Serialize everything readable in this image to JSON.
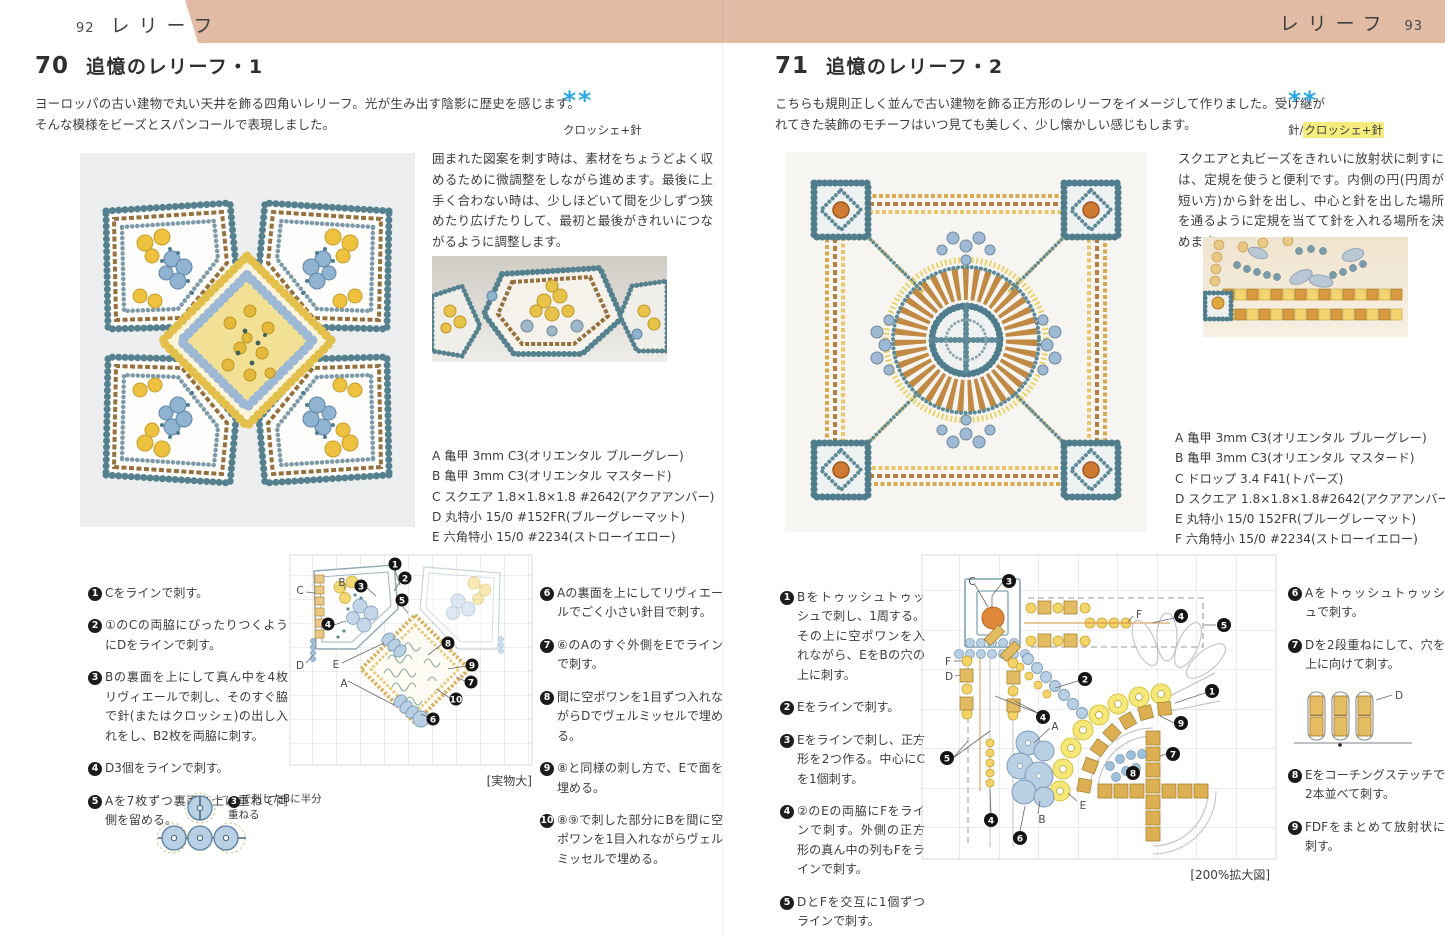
{
  "banner": {
    "color": "#e2bba4"
  },
  "left": {
    "page_number": "92",
    "section_label": "レリーフ",
    "item_number": "70",
    "title": "追憶のレリーフ・1",
    "description": "ヨーロッパの古い建物で丸い天井を飾る四角いレリーフ。光が生み出す陰影に歴史を感じます。そんな模様をビーズとスパンコールで表現しました。",
    "stars": "**",
    "technique": "クロッシェ+針",
    "tip": "囲まれた図案を刺す時は、素材をちょうどよく収めるために微調整をしながら進めます。最後に上手く合わない時は、少しほどいて間を少しずつ狭めたり広げたりして、最初と最後がきれいにつながるように調整します。",
    "materials": [
      "A 亀甲 3mm C3(オリエンタル ブルーグレー)",
      "B 亀甲 3mm C3(オリエンタル マスタード)",
      "C スクエア 1.8×1.8×1.8 #2642(アクアアンバー)",
      "D 丸特小 15/0 #152FR(ブルーグレーマット)",
      "E 六角特小 15/0 #2234(ストローイエロー)"
    ],
    "steps_col1": [
      {
        "num": "1",
        "text": "Cをラインで刺す。"
      },
      {
        "num": "2",
        "text": "①のCの両脇にぴったりつくようにDをラインで刺す。"
      },
      {
        "num": "3",
        "text": "Bの裏面を上にして真ん中を4枚リヴィエールで刺し、そのすぐ脇で針(またはクロッシェ)の出し入れをし、B2枚を両脇に刺す。"
      },
      {
        "num": "4",
        "text": "D3個をラインで刺す。"
      },
      {
        "num": "5",
        "text": "Aを7枚ずつ裏面を上に重ねて両側を留める。"
      }
    ],
    "steps_col2": [
      {
        "num": "6",
        "text": "Aの裏面を上にしてリヴィエールでごく小さい針目で刺す。"
      },
      {
        "num": "7",
        "text": "⑥のAのすぐ外側をEでラインで刺す。"
      },
      {
        "num": "8",
        "text": "間に空ポワンを1目ずつ入れながらDでヴェルミッセルで埋める。"
      },
      {
        "num": "9",
        "text": "⑧と同様の刺し方で、Eで面を埋める。"
      },
      {
        "num": "10",
        "text": "⑧⑨で刺した部分にBを間に空ポワンを1目入れながらヴェルミッセルで埋める。"
      }
    ],
    "note": {
      "num": "3",
      "text": "で刺したBに半分重ねる"
    },
    "diagram": {
      "scale_label": "[実物大]",
      "letters": [
        "C",
        "B",
        "D",
        "E",
        "A"
      ],
      "numbers": [
        "1",
        "2",
        "3",
        "4",
        "5",
        "6",
        "7",
        "8",
        "9",
        "10"
      ]
    }
  },
  "right": {
    "page_number": "93",
    "section_label": "レリーフ",
    "item_number": "71",
    "title": "追憶のレリーフ・2",
    "description": "こちらも規則正しく並んで古い建物を飾る正方形のレリーフをイメージして作りました。受け継がれてきた装飾のモチーフはいつ見ても美しく、少し懐かしい感じもします。",
    "stars": "**",
    "technique_prefix": "針/",
    "technique_highlight": "クロッシェ+針",
    "tip": "スクエアと丸ビーズをきれいに放射状に刺すには、定規を使うと便利です。内側の円(円周が短い方)から針を出し、中心と針を出した場所を通るように定規を当てて針を入れる場所を決めます。",
    "materials": [
      "A 亀甲 3mm C3(オリエンタル ブルーグレー)",
      "B 亀甲 3mm C3(オリエンタル マスタード)",
      "C ドロップ 3.4 F41(トパーズ)",
      "D スクエア 1.8×1.8×1.8#2642(アクアアンバー)",
      "E 丸特小 15/0 152FR(ブルーグレーマット)",
      "F 六角特小 15/0 #2234(ストローイエロー)"
    ],
    "steps_col1": [
      {
        "num": "1",
        "text": "Bをトゥッシュトゥッシュで刺し、1周する。その上に空ポワンを入れながら、EをBの穴の上に刺す。"
      },
      {
        "num": "2",
        "text": "Eをラインで刺す。"
      },
      {
        "num": "3",
        "text": "Eをラインで刺し、正方形を2つ作る。中心にCを1個刺す。"
      },
      {
        "num": "4",
        "text": "②のEの両脇にFをラインで刺す。外側の正方形の真ん中の列もFをラインで刺す。"
      },
      {
        "num": "5",
        "text": "DとFを交互に1個ずつラインで刺す。"
      }
    ],
    "steps_col2": [
      {
        "num": "6",
        "text": "Aをトゥッシュトゥッシュで刺す。"
      },
      {
        "num": "7",
        "text": "Dを2段重ねにして、穴を上に向けて刺す。"
      },
      {
        "num": "8",
        "text": "Eをコーチングステッチで2本並べて刺す。"
      },
      {
        "num": "9",
        "text": "FDFをまとめて放射状に刺す。"
      }
    ],
    "mini_diagram_label": "D",
    "diagram": {
      "scale_label": "[200%拡大図]",
      "letters": [
        "C",
        "F",
        "D",
        "A",
        "E",
        "B"
      ],
      "numbers": [
        "1",
        "2",
        "3",
        "4",
        "5",
        "6",
        "7",
        "8",
        "9"
      ]
    }
  }
}
